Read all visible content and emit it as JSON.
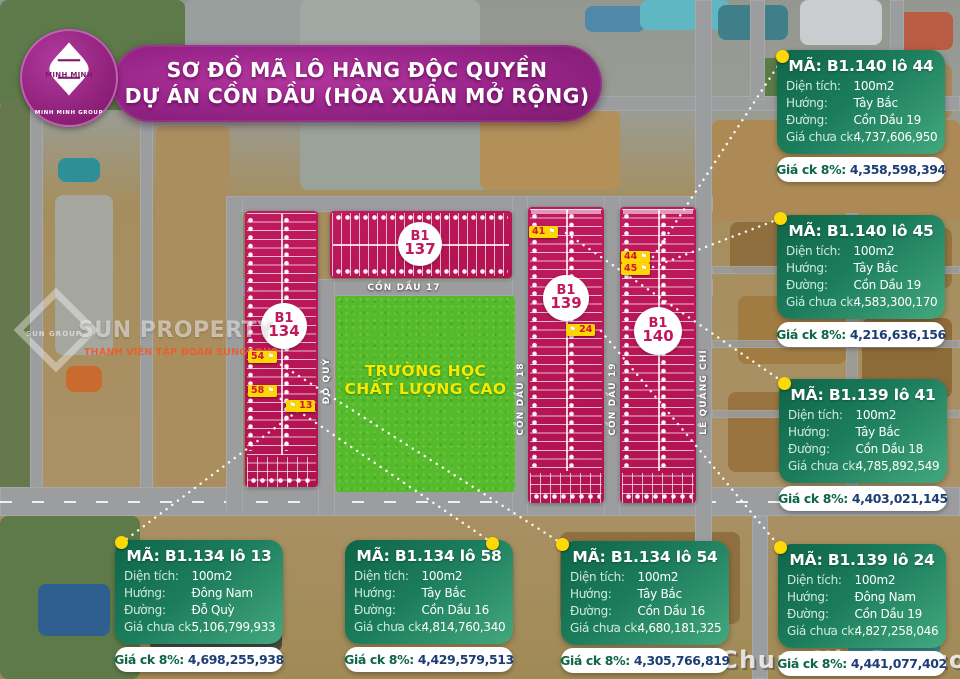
{
  "title": {
    "line1": "SƠ ĐỒ MÃ LÔ HÀNG ĐỘC QUYỀN",
    "line2": "DỰ ÁN CỒN DẦU (HÒA XUÂN MỞ RỘNG)"
  },
  "logo": {
    "name": "MINH MINH",
    "group": "MINH MINH GROUP"
  },
  "row_labels": {
    "area": "Diện tích:",
    "direction": "Hướng:",
    "street": "Đường:",
    "price": "Giá chưa ck:",
    "discount": "Giá ck 8%:"
  },
  "cards": [
    {
      "ma": "MÃ: B1.140 lô 44",
      "area": "100m2",
      "direction": "Tây Bắc",
      "street": "Cồn Dầu 19",
      "price": "4,737,606,950",
      "discount_price": "4,358,598,394"
    },
    {
      "ma": "MÃ: B1.140 lô 45",
      "area": "100m2",
      "direction": "Tây Bắc",
      "street": "Cồn Dầu 19",
      "price": "4,583,300,170",
      "discount_price": "4,216,636,156"
    },
    {
      "ma": "MÃ: B1.139 lô 41",
      "area": "100m2",
      "direction": "Tây Bắc",
      "street": "Cồn Dầu 18",
      "price": "4,785,892,549",
      "discount_price": "4,403,021,145"
    },
    {
      "ma": "MÃ: B1.134 lô 13",
      "area": "100m2",
      "direction": "Đông Nam",
      "street": "Đỗ Quỳ",
      "price": "5,106,799,933",
      "discount_price": "4,698,255,938"
    },
    {
      "ma": "MÃ: B1.134 lô 58",
      "area": "100m2",
      "direction": "Tây Bắc",
      "street": "Cồn Dầu 16",
      "price": "4,814,760,340",
      "discount_price": "4,429,579,513"
    },
    {
      "ma": "MÃ: B1.134 lô 54",
      "area": "100m2",
      "direction": "Tây Bắc",
      "street": "Cồn Dầu 16",
      "price": "4,680,181,325",
      "discount_price": "4,305,766,819"
    },
    {
      "ma": "MÃ: B1.139 lô 24",
      "area": "100m2",
      "direction": "Đông Nam",
      "street": "Cồn Dầu 19",
      "price": "4,827,258,046",
      "discount_price": "4,441,077,402"
    }
  ],
  "map": {
    "blocks": [
      {
        "l1": "B1",
        "l2": "137"
      },
      {
        "l1": "B1",
        "l2": "134"
      },
      {
        "l1": "B1",
        "l2": "139"
      },
      {
        "l1": "B1",
        "l2": "140"
      }
    ],
    "streets": {
      "cd17": "CỒN DẦU 17",
      "doquy": "ĐỖ QUỲ",
      "cd18": "CỒN DẦU 18",
      "cd19": "CỒN DẦU 19",
      "lqc": "LÊ QUẢNG CHÍ"
    },
    "school": {
      "line1": "TRƯỜNG HỌC",
      "line2": "CHẤT LƯỢNG CAO"
    },
    "tags": [
      "54",
      "58",
      "13",
      "41",
      "24",
      "44",
      "45"
    ]
  },
  "watermarks": {
    "sun_group": "SUN GROUP",
    "sun_property": "SUN PROPERTY",
    "sun_member": "THÀNH VIÊN TẬP ĐOÀN SUNGROUP",
    "site": "ChuanNhaĐat.com"
  },
  "colors": {
    "block_magenta": "#bc1557",
    "card_green_dark": "#0e6647",
    "card_green_light": "#43a87e",
    "banner_purple": "#99258a",
    "tag_yellow": "#ffd600",
    "school_green": "#55bb2b",
    "price_navy": "#1c3e74",
    "discount_green": "#0e6647"
  }
}
